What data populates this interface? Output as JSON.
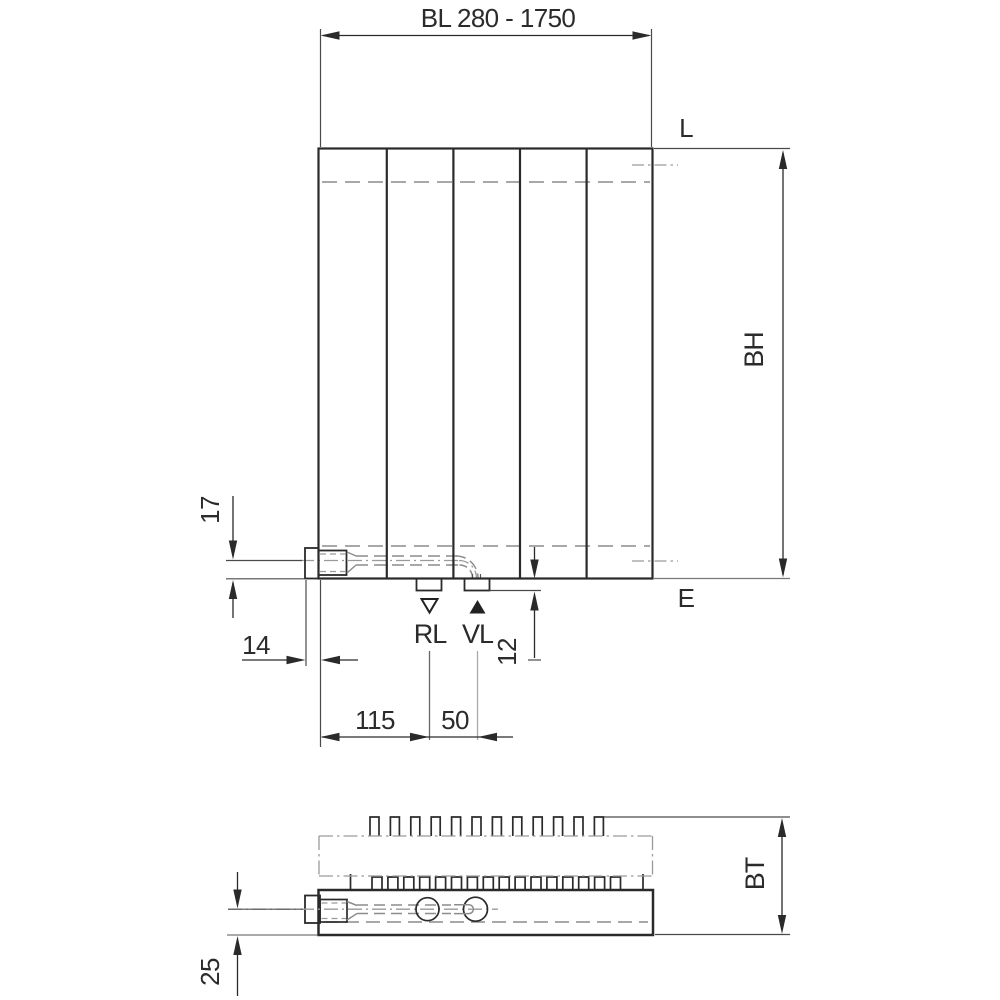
{
  "meta": {
    "type": "technical-dimension-drawing",
    "subject": "vertical panel radiator: front elevation (top) and horizontal section / plan view (bottom) with connection dimensions"
  },
  "colors": {
    "ink": "#2a2a2a",
    "hidden_line": "#8c8c8c",
    "center_line": "#9a9a9a",
    "thin_line": "#4a4a4a",
    "background": "#ffffff"
  },
  "front_view": {
    "width_dimension": "BL 280 - 1750",
    "top_edge_label": "L",
    "bottom_edge_label": "E",
    "height_dimension": "BH",
    "return_connection_label": "RL",
    "supply_connection_label": "VL",
    "dim_connector_axis_to_bottom": "17",
    "dim_connector_to_left_edge": "14",
    "dim_stub_height": "12",
    "dim_left_edge_to_rl": "115",
    "dim_rl_to_vl": "50"
  },
  "plan_view": {
    "depth_dimension": "BT",
    "dim_pipe_axis_to_front": "25"
  }
}
